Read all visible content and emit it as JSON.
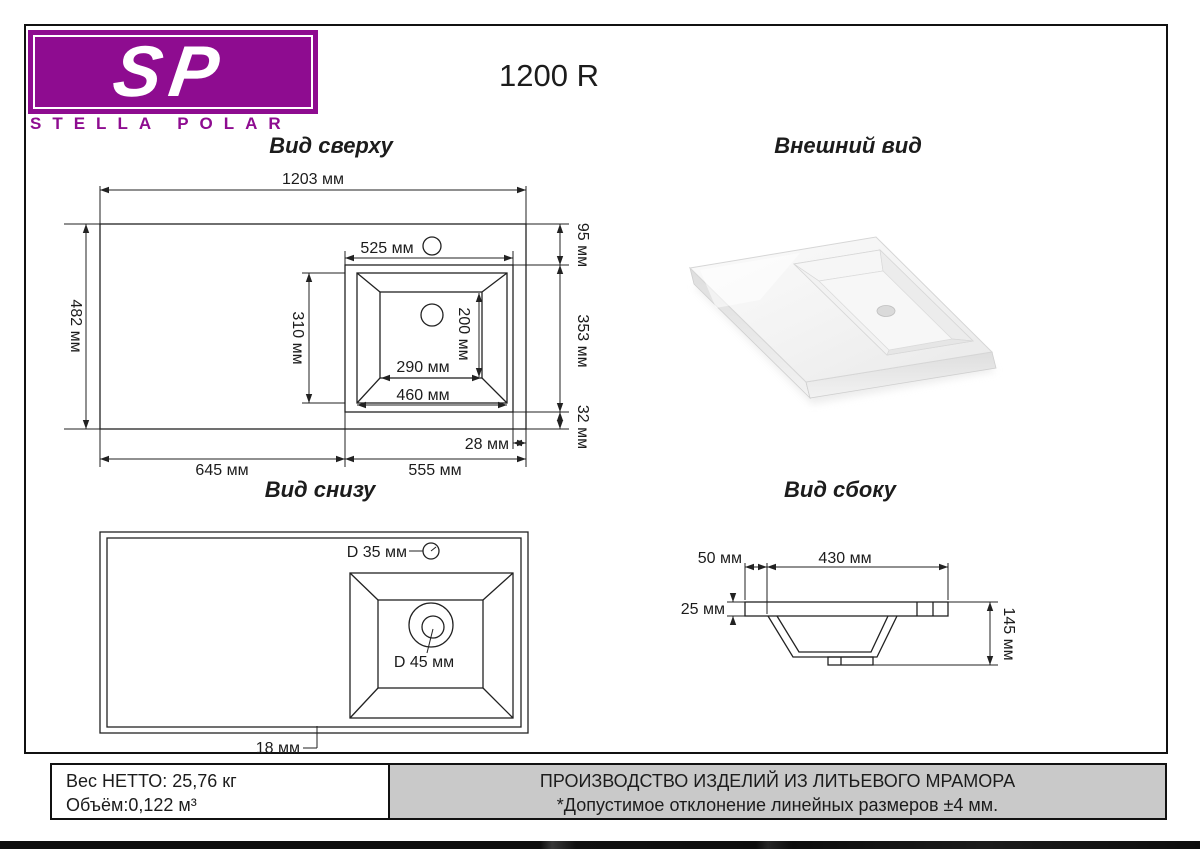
{
  "brand": {
    "sp": "SP",
    "name": "STELLA POLAR"
  },
  "product_title": "1200 R",
  "top_view": {
    "title": "Вид сверху",
    "dim_width_total": "1203 мм",
    "dim_depth_total": "482 мм",
    "dim_sink_width": "525 мм",
    "dim_rim_depth": "310 мм",
    "dim_basin_bottom_depth": "200 мм",
    "dim_basin_bottom_width": "290 мм",
    "dim_rim_width": "460 мм",
    "dim_back_gap": "95 мм",
    "dim_sink_depth": "353 мм",
    "dim_front_gap": "32 мм",
    "dim_side_gap": "28 мм",
    "dim_left_section": "645 мм",
    "dim_right_section": "555 мм"
  },
  "external_view": {
    "title": "Внешний вид"
  },
  "bottom_view": {
    "title": "Вид снизу",
    "dim_faucet_hole": "D 35 мм",
    "dim_drain_hole": "D 45 мм",
    "dim_wall_thickness": "18 мм"
  },
  "side_view": {
    "title": "Вид сбоку",
    "dim_edge_offset": "50 мм",
    "dim_basin_width": "430 мм",
    "dim_slab_thickness": "25 мм",
    "dim_total_height": "145 мм"
  },
  "footer": {
    "weight": "Вес НЕТТО: 25,76 кг",
    "volume": "Объём:0,122 м³",
    "production": "ПРОИЗВОДСТВО ИЗДЕЛИЙ ИЗ ЛИТЬЕВОГО МРАМОРА",
    "tolerance": "*Допустимое отклонение линейных размеров ±4 мм."
  },
  "colors": {
    "brand_purple": "#8e0c90",
    "footer_gray": "#c9c9c9",
    "line": "#222222"
  }
}
